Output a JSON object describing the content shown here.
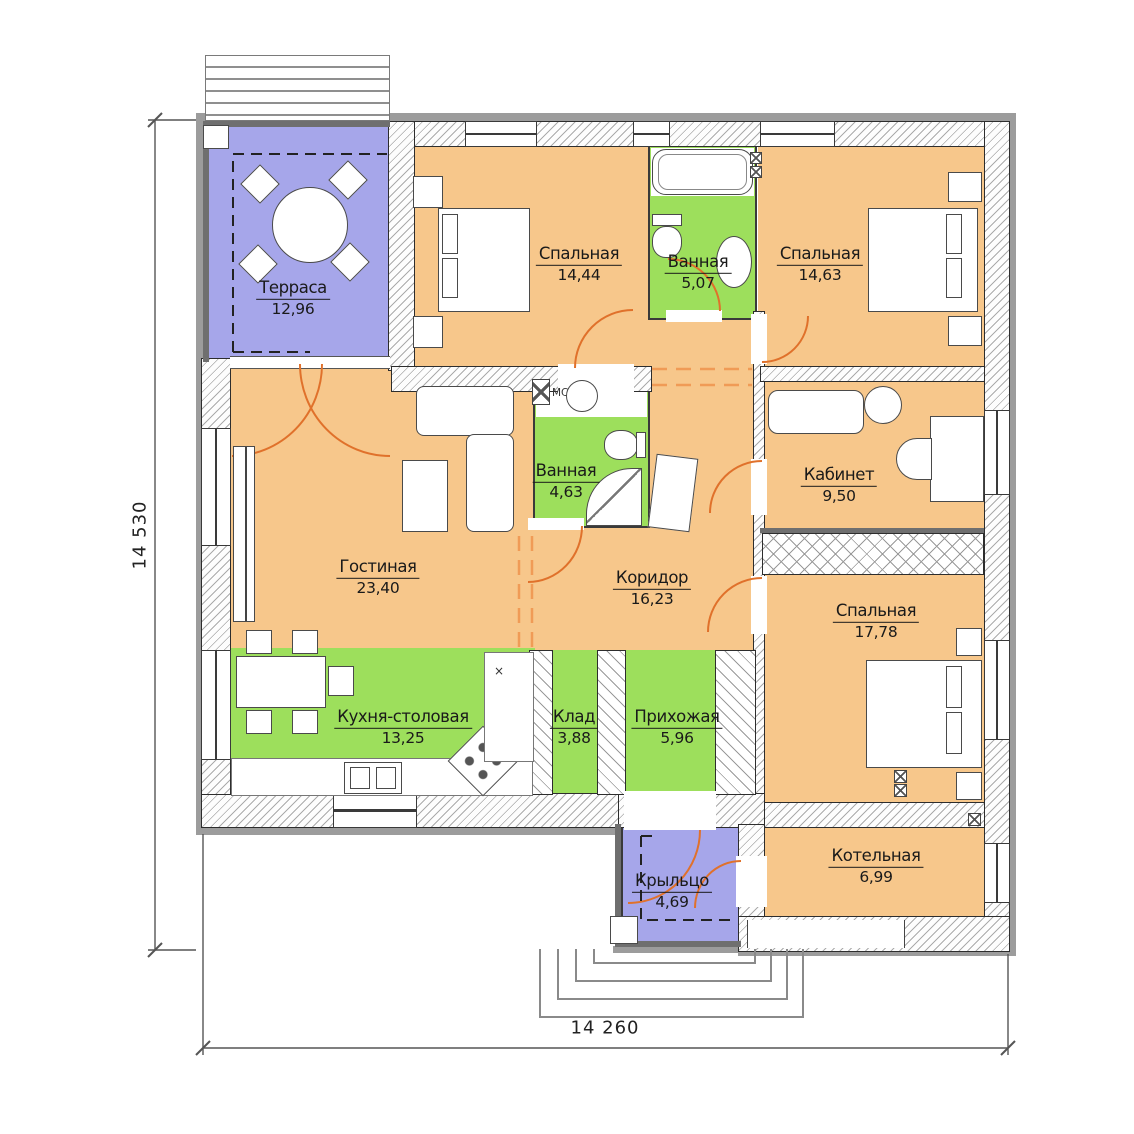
{
  "drawing": {
    "type": "floor-plan",
    "rooms": [
      {
        "name": "Терраса",
        "area": "12,96"
      },
      {
        "name": "Спальная",
        "area": "14,44"
      },
      {
        "name": "Ванная",
        "area": "5,07"
      },
      {
        "name": "Спальная",
        "area": "14,63"
      },
      {
        "name": "Гостиная",
        "area": "23,40"
      },
      {
        "name": "Ванная",
        "area": "4,63"
      },
      {
        "name": "Кабинет",
        "area": "9,50"
      },
      {
        "name": "Коридор",
        "area": "16,23"
      },
      {
        "name": "Спальная",
        "area": "17,78"
      },
      {
        "name": "Кухня-столовая",
        "area": "13,25"
      },
      {
        "name": "Клад",
        "area": "3,88"
      },
      {
        "name": "Прихожая",
        "area": "5,96"
      },
      {
        "name": "Крыльцо",
        "area": "4,69"
      },
      {
        "name": "Котельная",
        "area": "6,99"
      }
    ],
    "dimensions": {
      "height_label": "14 530",
      "width_label": "14 260"
    },
    "annotations": {
      "washer_label": "МС",
      "counter_mark": "×"
    },
    "colors": {
      "room_orange": "#f7c78b",
      "room_green": "#9ddf5c",
      "room_blue": "#a6a6ea",
      "door_arc": "#e0712b",
      "dashed_opening": "#f09b56",
      "wall_outline": "#2d2d2d",
      "facade_band": "#9c9c9c"
    }
  }
}
